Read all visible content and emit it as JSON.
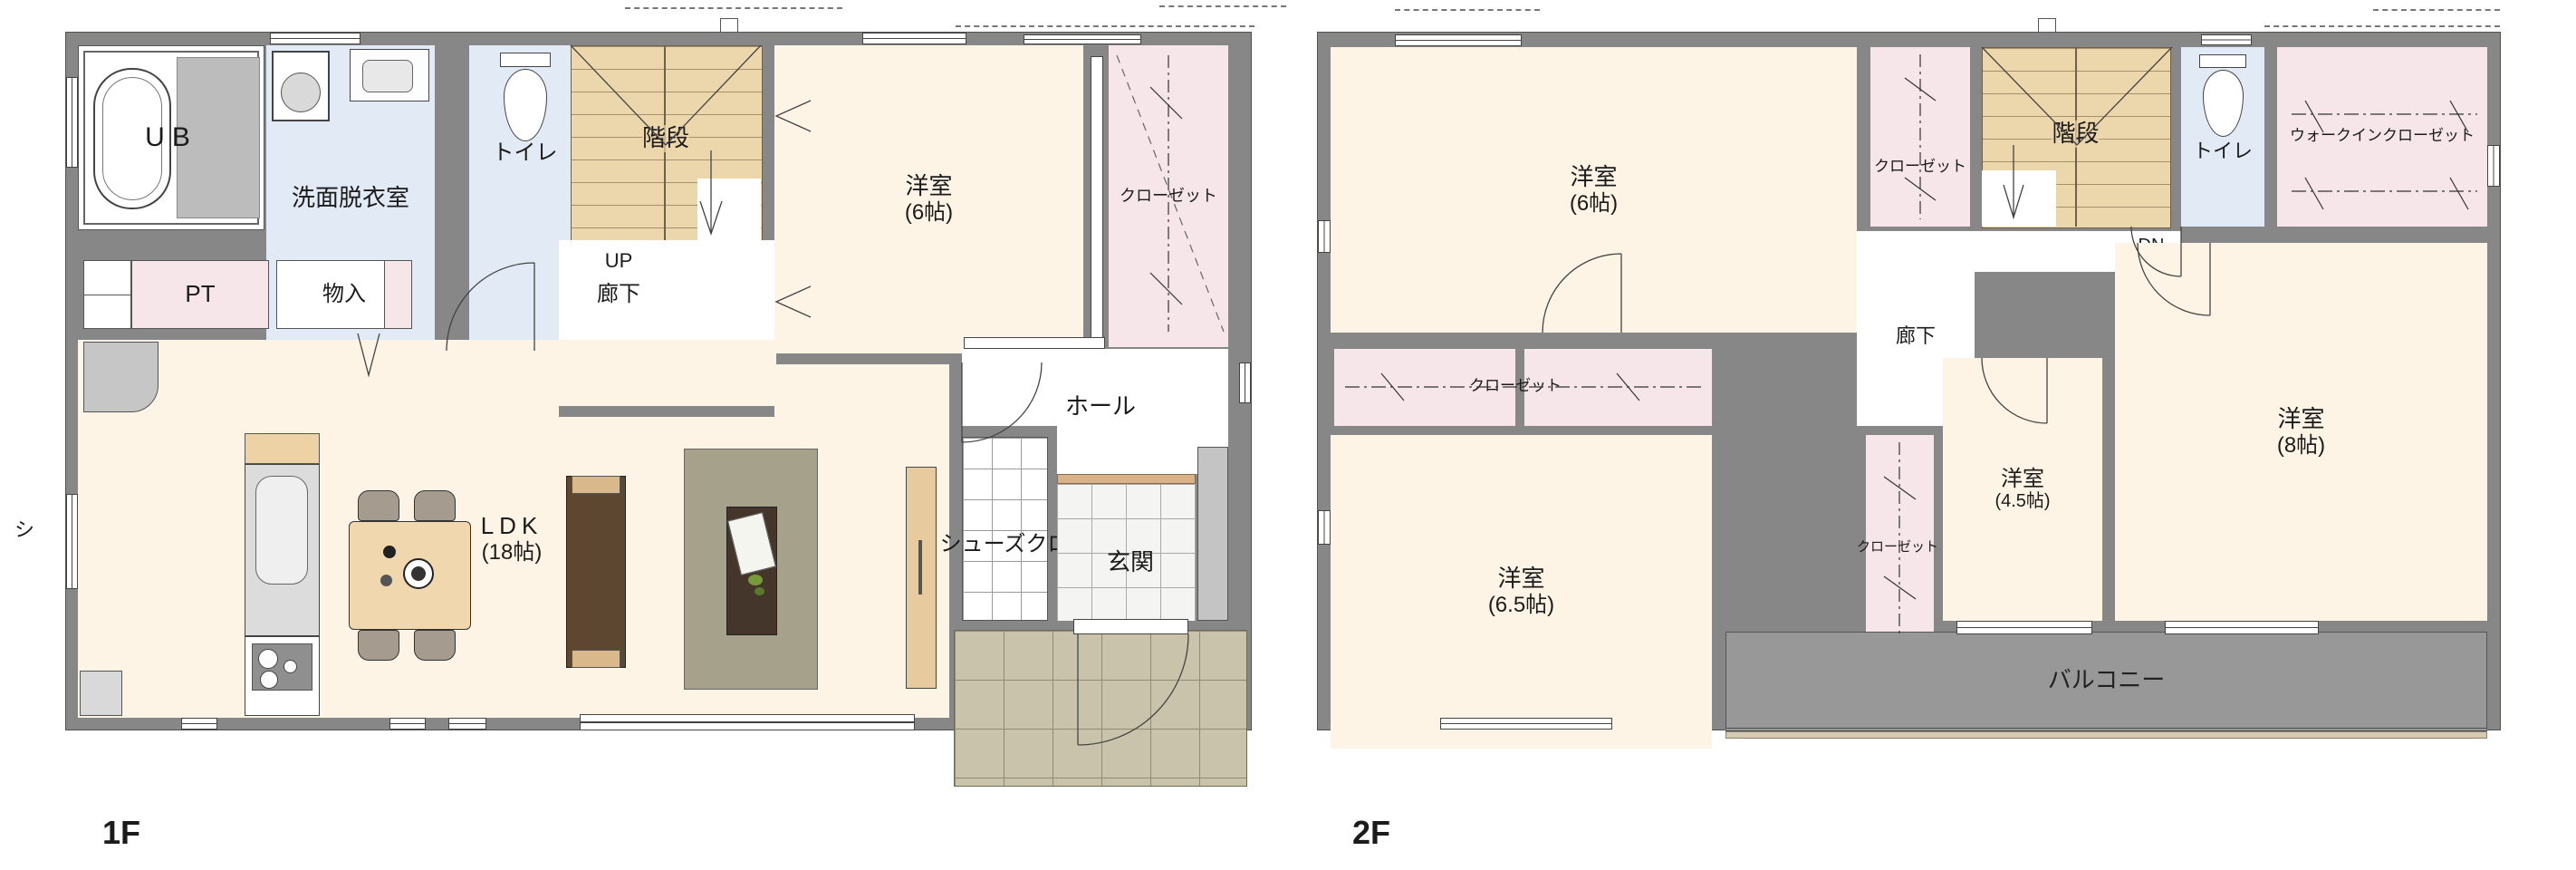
{
  "title_labels": {
    "floor1": "1F",
    "floor2": "2F",
    "side_note": "シ"
  },
  "floor1": {
    "ub": "UB",
    "senmen": "洗面脱衣室",
    "toilet": "トイレ",
    "kaidan": "階段",
    "up": "UP",
    "rouka": "廊下",
    "yoshitsu": "洋室",
    "yoshitsu_size": "(6帖)",
    "closet": "クローゼット",
    "pt": "PT",
    "monoire": "物入",
    "ldk": "LDK",
    "ldk_size": "(18帖)",
    "hall": "ホール",
    "shoes_cloak": "シューズクローク",
    "genkan": "玄関"
  },
  "floor2": {
    "yoshitsu6": "洋室",
    "yoshitsu6_size": "(6帖)",
    "closet_main": "クローゼット",
    "kaidan": "階段",
    "dn": "DN",
    "toilet": "トイレ",
    "wic": "ウォークインクローゼット",
    "rouka": "廊下",
    "closet_65": "クローゼット",
    "closet_45": "クローゼット",
    "yoshitsu65": "洋室",
    "yoshitsu65_size": "(6.5帖)",
    "yoshitsu45": "洋室",
    "yoshitsu45_size": "(4.5帖)",
    "yoshitsu8": "洋室",
    "yoshitsu8_size": "(8帖)",
    "balcony": "バルコニー"
  },
  "colors": {
    "wall": "#878787",
    "room_cream": "#fdf4e5",
    "room_blue": "#e2eaf5",
    "room_pink": "#f6e6ea",
    "stairs_tan": "#ecd7ac",
    "porch_tile": "#c9c3ab",
    "balcony": "#989898"
  }
}
